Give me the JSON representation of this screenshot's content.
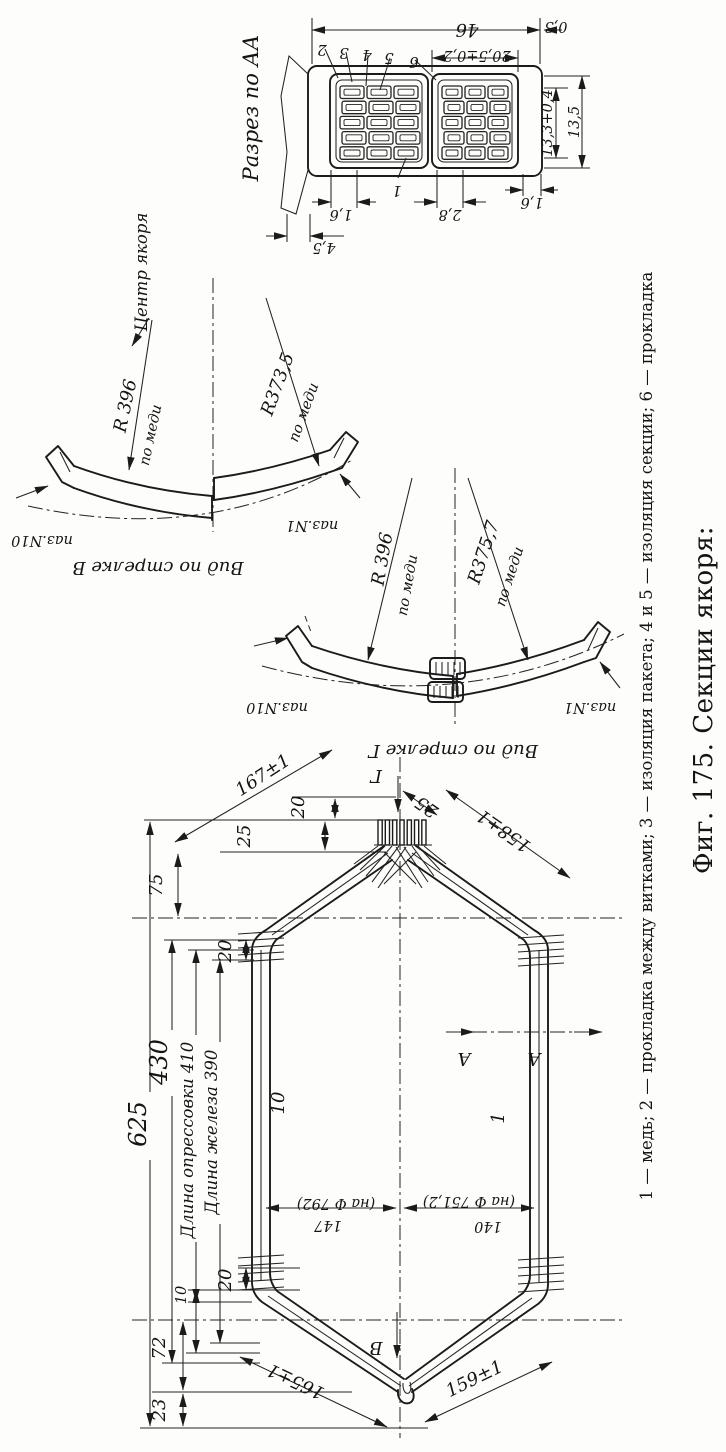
{
  "figure": {
    "number_title": "Фиг. 175. Секции якоря:",
    "legend": "1 — медь; 2 — прокладка между витками; 3 — изоляция пакета; 4 и 5 — изоляция секции; 6 — прокладка"
  },
  "section_aa": {
    "title": "Разрез по АА",
    "dims": {
      "width_total": "46",
      "liner": "0,3",
      "packet_width": "20,5±0,2",
      "slot_h1": "13,3+0,4",
      "slot_h2": "13,5",
      "cond_left": "1,6",
      "cond_mid": "2,8",
      "cond_right": "1,6",
      "wedge": "4,5"
    },
    "callouts": {
      "c1": "1",
      "c2": "2",
      "c3": "3",
      "c4": "4",
      "c5": "5",
      "c6": "6"
    }
  },
  "view_b": {
    "title": "Вид по стрелке В",
    "center_label": "Центр якоря",
    "radius_left": "R 396",
    "radius_right": "R373,5",
    "copper_note": "по меди",
    "slot_left": "паз.N10",
    "slot_right": "паз.N1"
  },
  "view_g": {
    "title": "Вид по стрелке Г",
    "radius_left": "R 396",
    "radius_right": "R375,7",
    "copper_note": "по меди",
    "slot_left": "паз.N10",
    "slot_right": "паз.N1"
  },
  "coil": {
    "arrow_g": "Г",
    "arrow_b": "В",
    "section_mark": "А",
    "side_label_left": "10",
    "side_label_right": "1",
    "dims": {
      "total": "625",
      "press_total": "430",
      "press_label": "Длина опрессовки 410",
      "iron_label": "Длина железа 390",
      "top_20": "20",
      "top_25": "25",
      "nose_20": "20",
      "shoulder_75": "75",
      "slant_ul": "167±1",
      "nose_25": "25",
      "slant_ur": "158±1",
      "step_left": "147",
      "step_left_note": "(на Ф 792)",
      "step_right": "140",
      "step_right_note": "(на Ф 751,2)",
      "bot_20": "20",
      "bot_10": "10",
      "bot_72": "72",
      "bot_23": "23",
      "slant_ll": "165±1",
      "slant_lr": "159±1"
    }
  }
}
